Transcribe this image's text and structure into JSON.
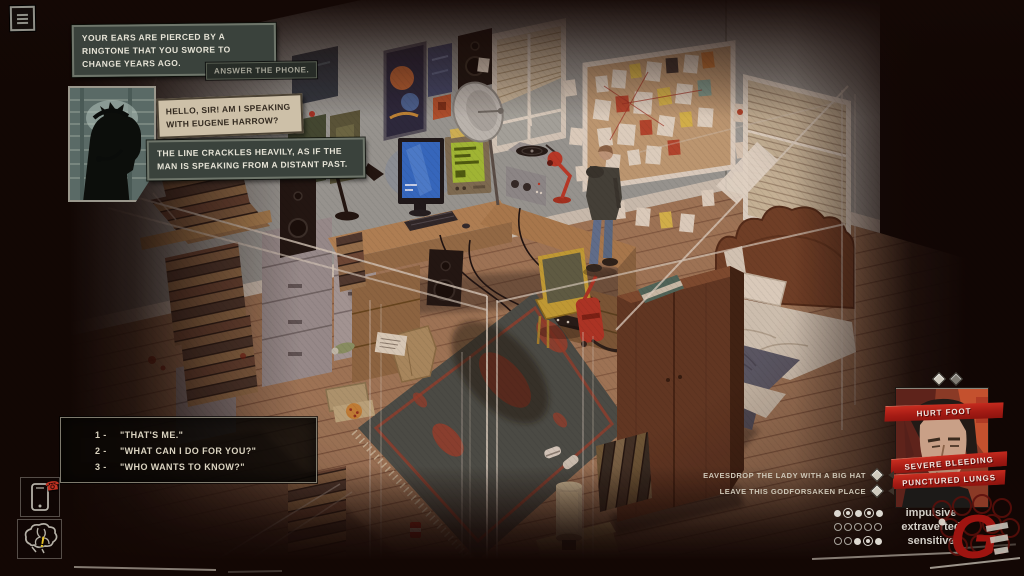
{
  "hud": {
    "narration_ringtone": "YOUR EARS ARE PIERCED BY A RINGTONE THAT YOU SWORE TO CHANGE YEARS AGO.",
    "action_prompt": "ANSWER THE PHONE.",
    "caller_line": "HELLO, SIR! AM I SPEAKING WITH EUGENE HARROW?",
    "narration_line_crackle": "THE LINE CRACKLES HEAVILY, AS IF THE MAN IS SPEAKING FROM A DISTANT PAST.",
    "dialogue_options": [
      {
        "num": "1 -",
        "text": "\"THAT'S ME.\""
      },
      {
        "num": "2 -",
        "text": "\"WHAT CAN I DO FOR YOU?\""
      },
      {
        "num": "3 -",
        "text": "\"WHO WANTS TO KNOW?\""
      }
    ]
  },
  "status": {
    "effects": [
      {
        "label": "HURT FOOT"
      },
      {
        "label": "SEVERE BLEEDING"
      },
      {
        "label": "PUNCTURED LUNGS"
      }
    ],
    "tasks": [
      {
        "label": "EAVESDROP THE LADY WITH A BIG HAT"
      },
      {
        "label": "LEAVE THIS GODFORSAKEN PLACE"
      }
    ],
    "traits": [
      {
        "label": "impulsive",
        "dots": [
          "filled",
          "selected",
          "filled",
          "selected",
          "filled"
        ]
      },
      {
        "label": "extraverted",
        "dots": [
          "empty",
          "empty",
          "empty",
          "empty",
          "empty"
        ]
      },
      {
        "label": "sensitive",
        "dots": [
          "empty",
          "empty",
          "filled",
          "selected",
          "filled"
        ]
      }
    ]
  },
  "icons": {
    "phone_badge": "☎",
    "brain_alert": "!"
  },
  "colors": {
    "banner_red": "#b2211a",
    "alert_yellow": "#e8c32a",
    "alert_red": "#c23222",
    "wood_floor": "#9e7a5c",
    "wall_grey": "#9aa19e"
  }
}
